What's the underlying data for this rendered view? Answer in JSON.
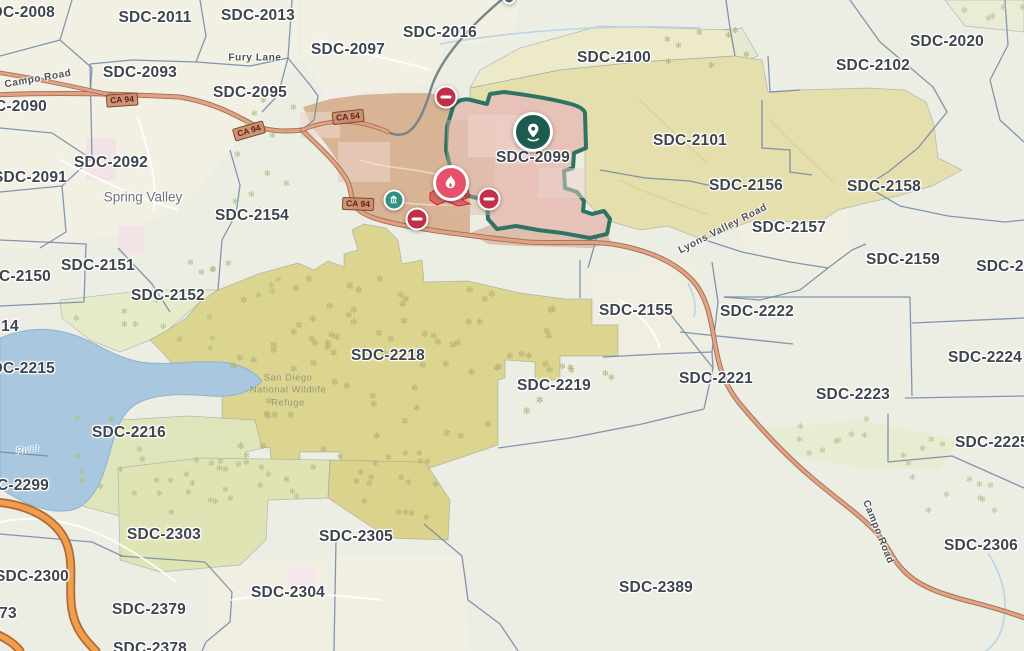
{
  "map": {
    "title": "Evacuation zone map",
    "highlighted_zone": {
      "id": "SDC-2099",
      "border_color": "#2e7363",
      "fill_color": "#e7c2b9"
    },
    "colors": {
      "base": "#ecede3",
      "zone_border": "#6e86a2",
      "label_text": "#3e454e",
      "zone_pink": "#e7c2b9",
      "zone_tan": "#d8b495",
      "zone_khaki": "#e5dead",
      "zone_olive": "#dcd58f",
      "zone_green": "#dfe3b3",
      "water": "#a9c7de",
      "highway_orange": "#ef9e4e",
      "road_salmon": "#e3a183",
      "marker_red": "#e8506b",
      "marker_closure": "#c03049",
      "marker_teal": "#2e9184",
      "marker_pin": "#1d5b51"
    },
    "zone_labels": [
      {
        "id": "SDC-2008",
        "x": 18,
        "y": 13
      },
      {
        "id": "SDC-2011",
        "x": 155,
        "y": 18
      },
      {
        "id": "SDC-2013",
        "x": 258,
        "y": 16
      },
      {
        "id": "SDC-2016",
        "x": 440,
        "y": 33
      },
      {
        "id": "SDC-2097",
        "x": 348,
        "y": 50
      },
      {
        "id": "SDC-2093",
        "x": 140,
        "y": 73
      },
      {
        "id": "SDC-2095",
        "x": 250,
        "y": 93
      },
      {
        "id": "SDC-2100",
        "x": 614,
        "y": 58
      },
      {
        "id": "SDC-2020",
        "x": 947,
        "y": 42
      },
      {
        "id": "SDC-2102",
        "x": 873,
        "y": 66
      },
      {
        "id": "SDC-2090",
        "x": 10,
        "y": 107
      },
      {
        "id": "SDC-2092",
        "x": 111,
        "y": 163
      },
      {
        "id": "SDC-2091",
        "x": 30,
        "y": 178
      },
      {
        "id": "SDC-2154",
        "x": 252,
        "y": 216
      },
      {
        "id": "SDC-2101",
        "x": 690,
        "y": 141
      },
      {
        "id": "SDC-2156",
        "x": 746,
        "y": 186
      },
      {
        "id": "SDC-2158",
        "x": 884,
        "y": 187
      },
      {
        "id": "SDC-2157",
        "x": 789,
        "y": 228
      },
      {
        "id": "SDC-2159",
        "x": 903,
        "y": 260
      },
      {
        "id": "SDC-2",
        "x": 1000,
        "y": 267
      },
      {
        "id": "SDC-2099",
        "x": 533,
        "y": 158
      },
      {
        "id": "SDC-2150",
        "x": 14,
        "y": 277
      },
      {
        "id": "SDC-2151",
        "x": 98,
        "y": 266
      },
      {
        "id": "SDC-2152",
        "x": 168,
        "y": 296
      },
      {
        "id": "14",
        "x": 10,
        "y": 327
      },
      {
        "id": "SDC-2155",
        "x": 636,
        "y": 311
      },
      {
        "id": "SDC-2222",
        "x": 757,
        "y": 312
      },
      {
        "id": "SDC-2221",
        "x": 716,
        "y": 379
      },
      {
        "id": "SDC-2218",
        "x": 388,
        "y": 356
      },
      {
        "id": "SDC-2219",
        "x": 554,
        "y": 386
      },
      {
        "id": "SDC-2223",
        "x": 853,
        "y": 395
      },
      {
        "id": "SDC-2224",
        "x": 985,
        "y": 358
      },
      {
        "id": "SDC-2215",
        "x": 18,
        "y": 369
      },
      {
        "id": "SDC-2216",
        "x": 129,
        "y": 433
      },
      {
        "id": "SDC-2225",
        "x": 992,
        "y": 443
      },
      {
        "id": "SDC-2299",
        "x": 12,
        "y": 486
      },
      {
        "id": "SDC-2303",
        "x": 164,
        "y": 535
      },
      {
        "id": "SDC-2305",
        "x": 356,
        "y": 537
      },
      {
        "id": "SDC-2300",
        "x": 32,
        "y": 577
      },
      {
        "id": "SDC-2304",
        "x": 288,
        "y": 593
      },
      {
        "id": "SDC-2379",
        "x": 149,
        "y": 610
      },
      {
        "id": "73",
        "x": 8,
        "y": 614
      },
      {
        "id": "SDC-2378",
        "x": 150,
        "y": 649
      },
      {
        "id": "SDC-2389",
        "x": 656,
        "y": 588
      },
      {
        "id": "SDC-2306",
        "x": 981,
        "y": 546
      }
    ],
    "place_labels": [
      {
        "text": "Spring Valley",
        "x": 143,
        "y": 197
      }
    ],
    "road_labels": [
      {
        "text": "Campo Road",
        "x": 38,
        "y": 79,
        "rot": -10
      },
      {
        "text": "Fury Lane",
        "x": 255,
        "y": 58,
        "rot": 0
      },
      {
        "text": "Lyons Valley Road",
        "x": 723,
        "y": 229,
        "rot": -27
      },
      {
        "text": "Campo Road",
        "x": 878,
        "y": 532,
        "rot": 68
      },
      {
        "text": "River",
        "x": 28,
        "y": 449,
        "rot": -10,
        "water": true
      }
    ],
    "area_labels": [
      {
        "text": "San Diego\nNational Wildlife\nRefuge",
        "x": 288,
        "y": 391
      }
    ],
    "highway_shields": [
      {
        "text": "CA 94",
        "x": 122,
        "y": 100,
        "rot": -4
      },
      {
        "text": "CA 94",
        "x": 249,
        "y": 131,
        "rot": -16
      },
      {
        "text": "CA 54",
        "x": 348,
        "y": 117,
        "rot": -6
      },
      {
        "text": "CA 94",
        "x": 358,
        "y": 204,
        "rot": 2
      }
    ],
    "markers": [
      {
        "name": "incident-location-marker",
        "glyph": "pin",
        "x": 533,
        "y": 132,
        "size": 40,
        "color": "#1d5b51"
      },
      {
        "name": "fire-marker",
        "glyph": "flame",
        "x": 451,
        "y": 183,
        "size": 36,
        "color": "#e8506b"
      },
      {
        "name": "road-closure-marker",
        "glyph": "no-entry",
        "x": 446,
        "y": 97,
        "size": 23,
        "color": "#c03049"
      },
      {
        "name": "road-closure-marker",
        "glyph": "no-entry",
        "x": 489,
        "y": 199,
        "size": 23,
        "color": "#c03049"
      },
      {
        "name": "road-closure-marker",
        "glyph": "no-entry",
        "x": 417,
        "y": 219,
        "size": 23,
        "color": "#c03049"
      },
      {
        "name": "facility-marker",
        "glyph": "building",
        "x": 394,
        "y": 200,
        "size": 21,
        "color": "#2e9184"
      },
      {
        "name": "clipped-marker",
        "glyph": "dot",
        "x": 509,
        "y": -2,
        "size": 13,
        "color": "#53616b"
      }
    ]
  }
}
